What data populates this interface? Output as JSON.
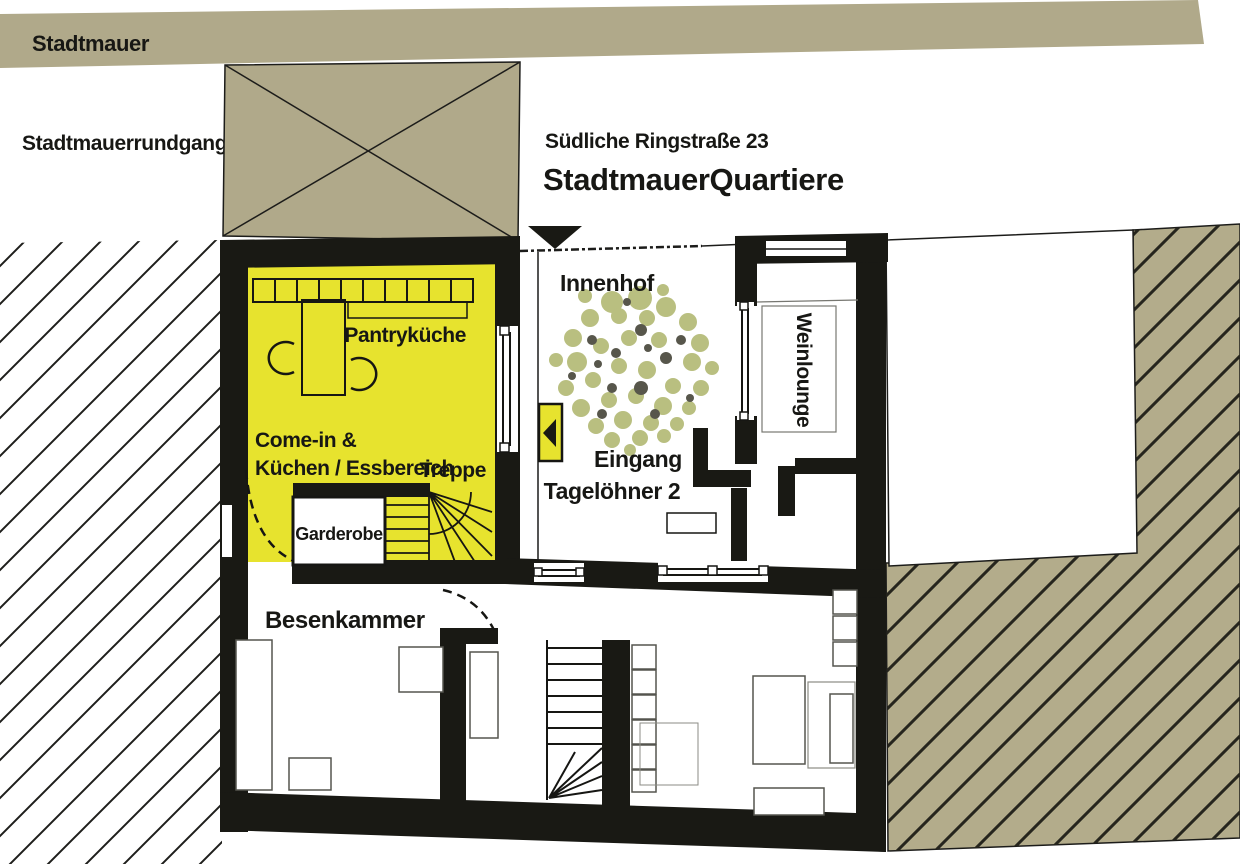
{
  "header": {
    "street": "Südliche Ringstraße 23",
    "building": "StadtmauerQuartiere"
  },
  "site": {
    "wall_label": "Stadtmauer",
    "walkway_label": "Stadtmauerrundgang"
  },
  "rooms": {
    "innenhof": "Innenhof",
    "pantry": "Pantryküche",
    "comein_line1": "Come-in &",
    "comein_line2": "Küchen / Essbereich",
    "treppe": "Treppe",
    "garderobe": "Garderobe",
    "besenkammer": "Besenkammer",
    "eingang_line1": "Eingang",
    "eingang_line2": "Tagelöhner 2",
    "weinlounge": "Weinlounge"
  },
  "colors": {
    "site_khaki": "#b0a98a",
    "hatch_khaki": "#b3ac8b",
    "room_yellow": "#e7e32e",
    "wall_black": "#191914",
    "tree_light": "#b9bf80",
    "tree_dark": "#57564b"
  }
}
